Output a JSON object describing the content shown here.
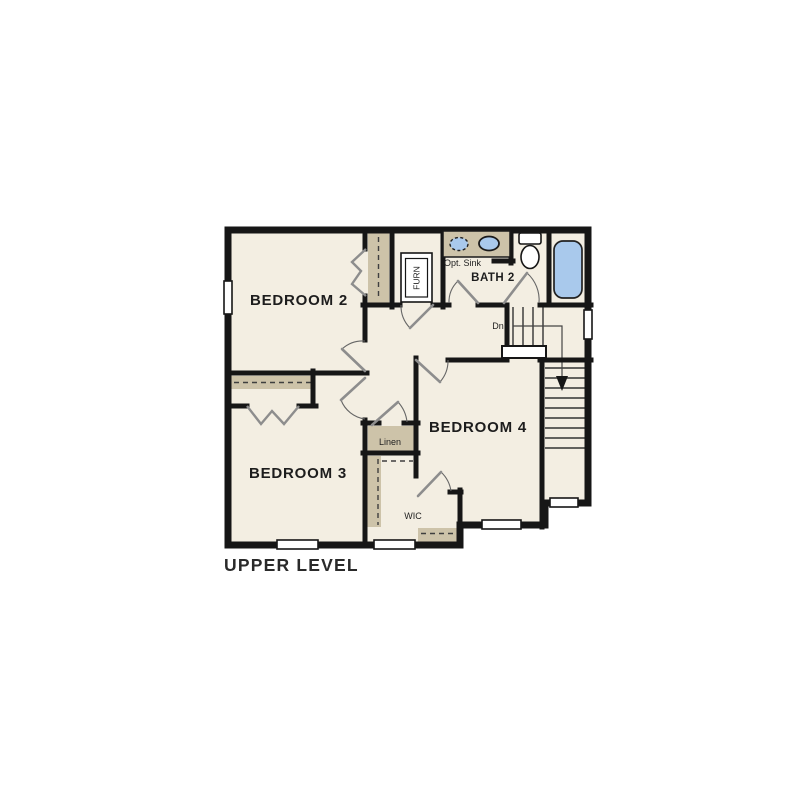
{
  "title": "UPPER LEVEL",
  "rooms": {
    "bedroom2": {
      "label": "BEDROOM 2"
    },
    "bedroom3": {
      "label": "BEDROOM 3"
    },
    "bedroom4": {
      "label": "BEDROOM 4"
    },
    "bath2": {
      "label": "BATH 2"
    },
    "linen": {
      "label": "Linen"
    },
    "wic": {
      "label": "WIC"
    },
    "furnace": {
      "label": "FURN"
    }
  },
  "annotations": {
    "opt_sink": "Opt. Sink",
    "down": "Dn"
  },
  "fixtures": [
    "optional-sink",
    "sink",
    "toilet",
    "bathtub",
    "furnace-unit",
    "stairs-down",
    "closet-shelves",
    "windows"
  ],
  "colors": {
    "floor": "#f3eee2",
    "wall": "#161616",
    "casework_tan": "#cdc3a9",
    "fixture_blue": "#a9c9ec",
    "text": "#1d1d1d"
  }
}
